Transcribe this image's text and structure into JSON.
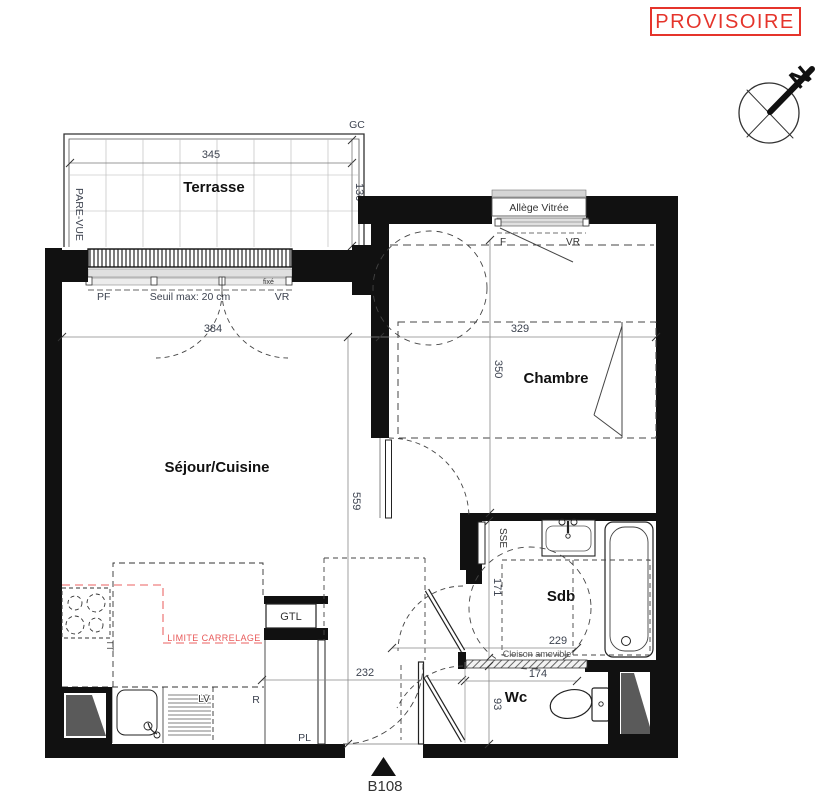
{
  "stamp": {
    "label": "PROVISOIRE"
  },
  "compass": {
    "north": "N"
  },
  "unit": {
    "number": "B108"
  },
  "rooms": {
    "terrace": "Terrasse",
    "living_kitchen": "Séjour/Cuisine",
    "bedroom": "Chambre",
    "bathroom": "Sdb",
    "wc": "Wc"
  },
  "dimensions_cm": {
    "terrace_width": "345",
    "terrace_depth": "130",
    "living_width": "384",
    "living_length": "559",
    "bedroom_width": "329",
    "bedroom_depth": "350",
    "bathroom_depth": "171",
    "bathroom_width": "229",
    "partition_length": "174",
    "entry_width": "232",
    "wc_depth": "93",
    "threshold_note": "Seuil max: 20 cm"
  },
  "annotations": {
    "gc": "GC",
    "pare_vue": "PARE-VUE",
    "window_left": "PF",
    "window_right": "VR",
    "window_fixed": "fixé",
    "glazed_sill": "Allège Vitrée",
    "bedroom_window_left": "F",
    "bedroom_window_right": "VR",
    "towel_dryer": "SSE",
    "movable_partition": "Cloison amovible",
    "tile_limit": "LIMITE CARRELAGE",
    "gtl": "GTL",
    "tt": "TT",
    "dishwasher": "LV",
    "fridge": "R",
    "closet": "PL"
  },
  "colors": {
    "wall_black": "#111111",
    "stamp_red": "#e5342b",
    "tile_limit_red": "#ef8080"
  }
}
